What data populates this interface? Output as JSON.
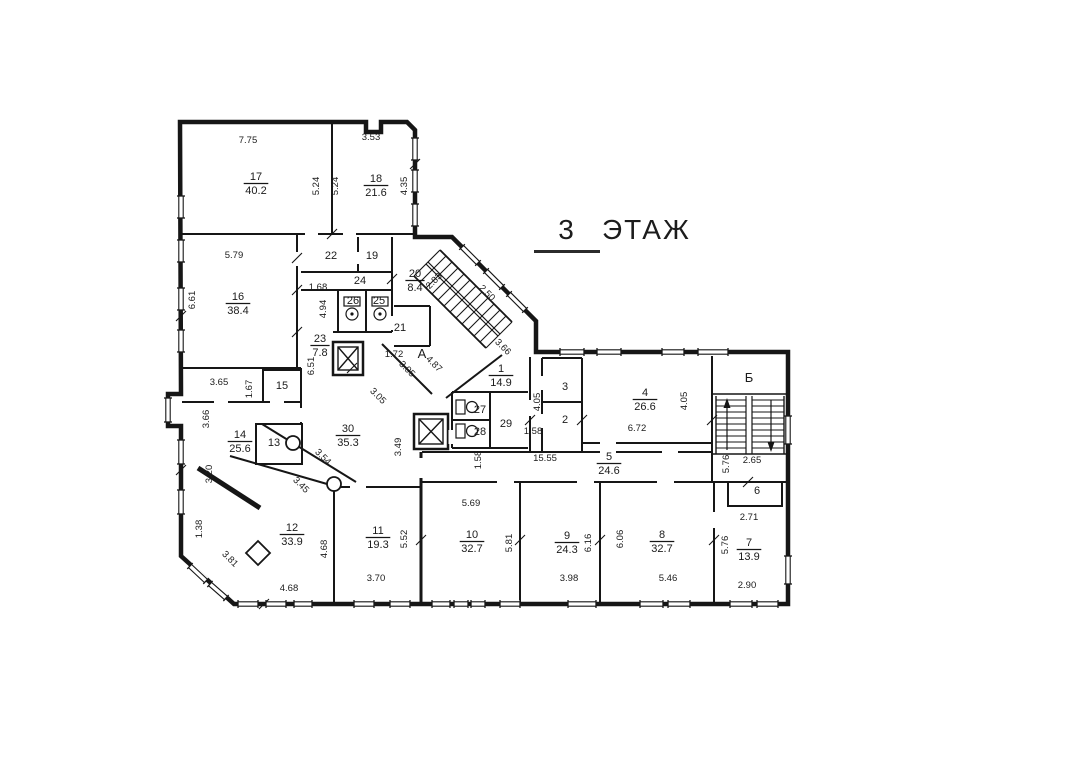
{
  "title": {
    "number": "3",
    "word": "ЭТАЖ"
  },
  "colors": {
    "ink": "#1b1b1b",
    "wall": "#161616",
    "paper": "#ffffff"
  },
  "stair_letters": [
    {
      "text": "А",
      "x": 422,
      "y": 358
    },
    {
      "text": "Б",
      "x": 749,
      "y": 382
    }
  ],
  "rooms": [
    {
      "num": "17",
      "area": "40.2",
      "x": 256,
      "y": 180
    },
    {
      "num": "18",
      "area": "21.6",
      "x": 376,
      "y": 182
    },
    {
      "num": "16",
      "area": "38.4",
      "x": 238,
      "y": 300
    },
    {
      "num": "22",
      "x": 331,
      "y": 259
    },
    {
      "num": "19",
      "x": 372,
      "y": 259
    },
    {
      "num": "24",
      "x": 360,
      "y": 284
    },
    {
      "num": "26",
      "x": 353,
      "y": 304
    },
    {
      "num": "25",
      "x": 379,
      "y": 304
    },
    {
      "num": "20",
      "area": "8.4",
      "x": 415,
      "y": 277
    },
    {
      "num": "21",
      "x": 400,
      "y": 331
    },
    {
      "num": "23",
      "area": "7.8",
      "x": 320,
      "y": 342
    },
    {
      "num": "15",
      "x": 282,
      "y": 389
    },
    {
      "num": "13",
      "x": 274,
      "y": 446
    },
    {
      "num": "14",
      "area": "25.6",
      "x": 240,
      "y": 438
    },
    {
      "num": "30",
      "area": "35.3",
      "x": 348,
      "y": 432
    },
    {
      "num": "12",
      "area": "33.9",
      "x": 292,
      "y": 531
    },
    {
      "num": "11",
      "area": "19.3",
      "x": 378,
      "y": 534
    },
    {
      "num": "1",
      "area": "14.9",
      "x": 501,
      "y": 372
    },
    {
      "num": "27",
      "x": 480,
      "y": 413
    },
    {
      "num": "28",
      "x": 480,
      "y": 435
    },
    {
      "num": "29",
      "x": 506,
      "y": 427
    },
    {
      "num": "3",
      "x": 565,
      "y": 390
    },
    {
      "num": "2",
      "x": 565,
      "y": 423
    },
    {
      "num": "4",
      "area": "26.6",
      "x": 645,
      "y": 396
    },
    {
      "num": "5",
      "area": "24.6",
      "x": 609,
      "y": 460
    },
    {
      "num": "6",
      "x": 757,
      "y": 494
    },
    {
      "num": "10",
      "area": "32.7",
      "x": 472,
      "y": 538
    },
    {
      "num": "9",
      "area": "24.3",
      "x": 567,
      "y": 539
    },
    {
      "num": "8",
      "area": "32.7",
      "x": 662,
      "y": 538
    },
    {
      "num": "7",
      "area": "13.9",
      "x": 749,
      "y": 546
    }
  ],
  "dimensions": [
    {
      "t": "7.75",
      "x": 248,
      "y": 143,
      "a": 0
    },
    {
      "t": "3.53",
      "x": 371,
      "y": 140,
      "a": 0
    },
    {
      "t": "5.24",
      "x": 319,
      "y": 186,
      "a": -90
    },
    {
      "t": "5.24",
      "x": 338,
      "y": 186,
      "a": -90
    },
    {
      "t": "4.35",
      "x": 407,
      "y": 186,
      "a": -90
    },
    {
      "t": "5.79",
      "x": 234,
      "y": 258,
      "a": 0
    },
    {
      "t": "6.61",
      "x": 195,
      "y": 300,
      "a": -90
    },
    {
      "t": "1.68",
      "x": 318,
      "y": 290,
      "a": 0
    },
    {
      "t": "4.94",
      "x": 326,
      "y": 309,
      "a": -90
    },
    {
      "t": "6.51",
      "x": 314,
      "y": 366,
      "a": -90
    },
    {
      "t": "2.83",
      "x": 436,
      "y": 283,
      "a": -45
    },
    {
      "t": "2.50",
      "x": 485,
      "y": 295,
      "a": 45
    },
    {
      "t": "1.72",
      "x": 394,
      "y": 357,
      "a": 0
    },
    {
      "t": "4.87",
      "x": 432,
      "y": 366,
      "a": 45
    },
    {
      "t": "3.05",
      "x": 405,
      "y": 371,
      "a": 45
    },
    {
      "t": "3.05",
      "x": 376,
      "y": 398,
      "a": 45
    },
    {
      "t": "3.66",
      "x": 501,
      "y": 349,
      "a": 45
    },
    {
      "t": "3.65",
      "x": 219,
      "y": 385,
      "a": 0
    },
    {
      "t": "1.67",
      "x": 252,
      "y": 389,
      "a": -90
    },
    {
      "t": "3.66",
      "x": 209,
      "y": 419,
      "a": -90
    },
    {
      "t": "3.20",
      "x": 212,
      "y": 474,
      "a": -90
    },
    {
      "t": "1.38",
      "x": 202,
      "y": 529,
      "a": -90
    },
    {
      "t": "3.81",
      "x": 228,
      "y": 561,
      "a": 45
    },
    {
      "t": "3.54",
      "x": 321,
      "y": 459,
      "a": 45
    },
    {
      "t": "3.45",
      "x": 299,
      "y": 487,
      "a": 45
    },
    {
      "t": "3.49",
      "x": 401,
      "y": 447,
      "a": -90
    },
    {
      "t": "4.05",
      "x": 540,
      "y": 402,
      "a": -90
    },
    {
      "t": "4.05",
      "x": 687,
      "y": 401,
      "a": -90
    },
    {
      "t": "6.72",
      "x": 637,
      "y": 431,
      "a": 0
    },
    {
      "t": "1.58",
      "x": 533,
      "y": 434,
      "a": 0
    },
    {
      "t": "1.58",
      "x": 481,
      "y": 460,
      "a": -90
    },
    {
      "t": "15.55",
      "x": 545,
      "y": 461,
      "a": 0
    },
    {
      "t": "5.76",
      "x": 729,
      "y": 464,
      "a": -90
    },
    {
      "t": "2.65",
      "x": 752,
      "y": 463,
      "a": 0
    },
    {
      "t": "2.71",
      "x": 749,
      "y": 520,
      "a": 0
    },
    {
      "t": "5.69",
      "x": 471,
      "y": 506,
      "a": 0
    },
    {
      "t": "5.81",
      "x": 512,
      "y": 543,
      "a": -90
    },
    {
      "t": "6.16",
      "x": 591,
      "y": 543,
      "a": -90
    },
    {
      "t": "6.06",
      "x": 623,
      "y": 539,
      "a": -90
    },
    {
      "t": "5.76",
      "x": 728,
      "y": 545,
      "a": -90
    },
    {
      "t": "4.68",
      "x": 327,
      "y": 549,
      "a": -90
    },
    {
      "t": "5.52",
      "x": 407,
      "y": 539,
      "a": -90
    },
    {
      "t": "3.70",
      "x": 376,
      "y": 581,
      "a": 0
    },
    {
      "t": "3.98",
      "x": 569,
      "y": 581,
      "a": 0
    },
    {
      "t": "5.46",
      "x": 668,
      "y": 581,
      "a": 0
    },
    {
      "t": "2.90",
      "x": 747,
      "y": 588,
      "a": 0
    },
    {
      "t": "4.68",
      "x": 289,
      "y": 591,
      "a": 0
    }
  ]
}
